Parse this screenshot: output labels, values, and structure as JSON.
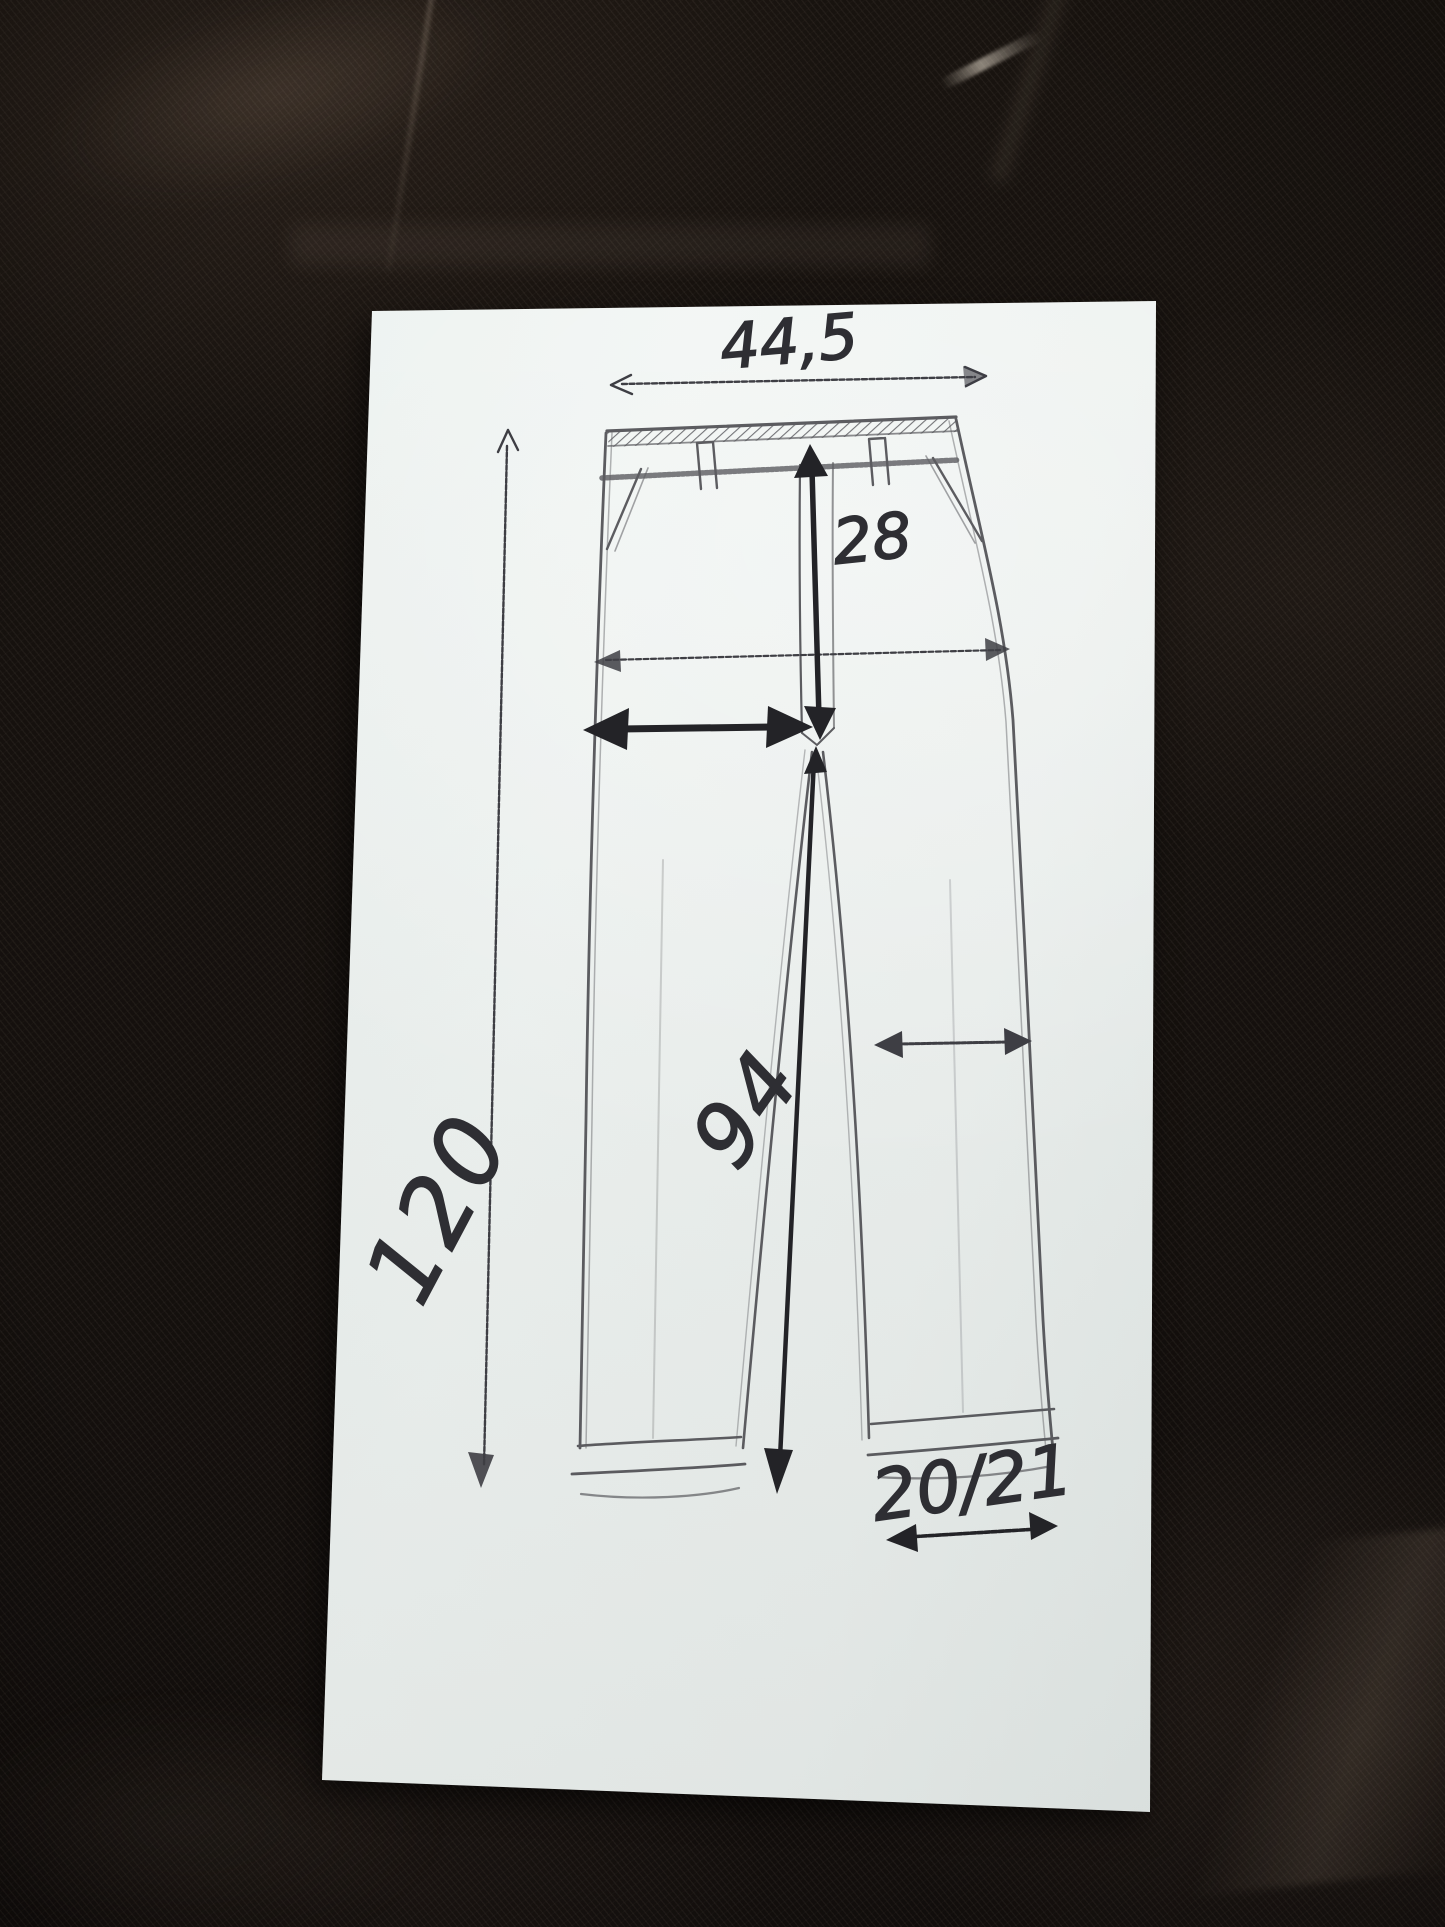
{
  "colors": {
    "fabric": "#17120f",
    "paper": "#eef2f0",
    "pencil": "#4b4b50",
    "pen": "#2e2e33",
    "arrow_dark": "#232327"
  },
  "measurements": {
    "waist_width": "44,5",
    "rise": "28",
    "outer_length": "120",
    "inseam": "94",
    "leg_opening": "20/21"
  }
}
